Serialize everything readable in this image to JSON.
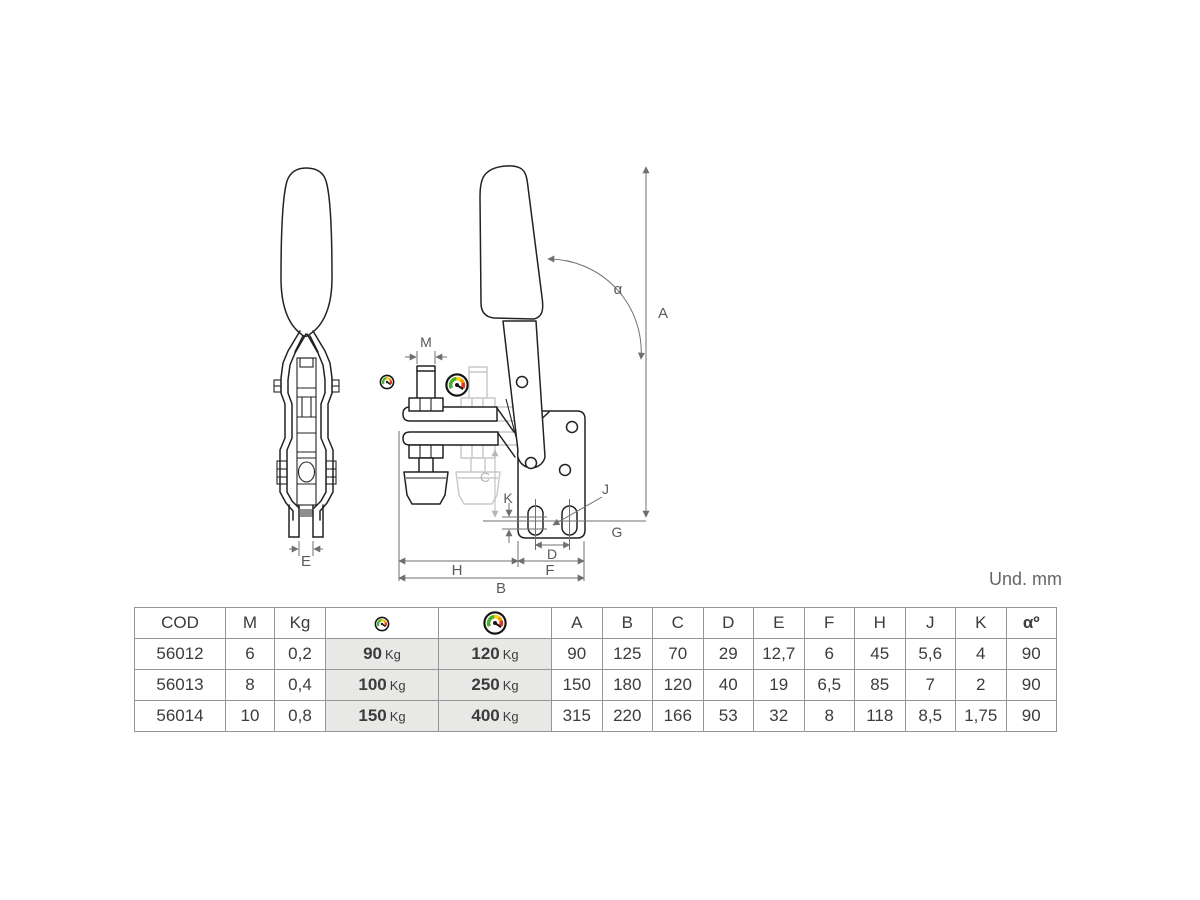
{
  "page": {
    "units_label": "Und. mm"
  },
  "colors": {
    "drawing_line": "#222222",
    "dimension_line": "#6f6f6f",
    "ghost_line": "#c8c8c8",
    "table_border": "#969696",
    "shaded_cell": "#e8e8e6",
    "gauge_green": "#4caf2f",
    "gauge_yellow": "#ffd200",
    "gauge_orange": "#f59a00",
    "gauge_red": "#e53518"
  },
  "diagram": {
    "labels": {
      "M": "M",
      "A": "A",
      "alpha": "α",
      "C": "C",
      "K": "K",
      "J": "J",
      "G": "G",
      "D": "D",
      "H": "H",
      "F": "F",
      "B": "B",
      "E": "E"
    },
    "icons": {
      "small_gauge": "gauge-icon-small",
      "large_gauge": "gauge-icon-large"
    }
  },
  "table": {
    "headers": {
      "cod": "COD",
      "m": "M",
      "kg": "Kg"
    },
    "dim_headers": [
      "A",
      "B",
      "C",
      "D",
      "E",
      "F",
      "H",
      "J",
      "K",
      "αº"
    ],
    "kg_unit": "Kg",
    "rows": [
      {
        "cod": "56012",
        "m": "6",
        "kg": "0,2",
        "f1": "90",
        "f2": "120",
        "dims": [
          "90",
          "125",
          "70",
          "29",
          "12,7",
          "6",
          "45",
          "5,6",
          "4",
          "90"
        ]
      },
      {
        "cod": "56013",
        "m": "8",
        "kg": "0,4",
        "f1": "100",
        "f2": "250",
        "dims": [
          "150",
          "180",
          "120",
          "40",
          "19",
          "6,5",
          "85",
          "7",
          "2",
          "90"
        ]
      },
      {
        "cod": "56014",
        "m": "10",
        "kg": "0,8",
        "f1": "150",
        "f2": "400",
        "dims": [
          "315",
          "220",
          "166",
          "53",
          "32",
          "8",
          "118",
          "8,5",
          "1,75",
          "90"
        ]
      }
    ]
  }
}
